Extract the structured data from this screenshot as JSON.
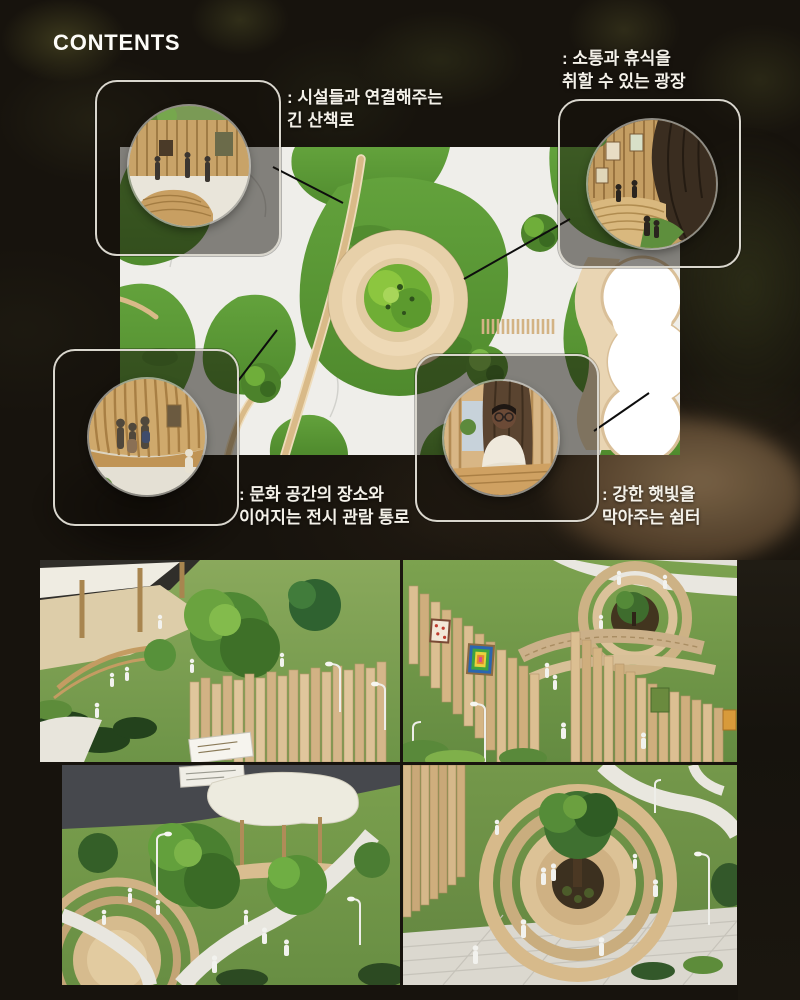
{
  "page": {
    "title": "CONTENTS"
  },
  "annotations": {
    "walkway": {
      "line1": ": 시설들과 연결해주는",
      "line2": "긴 산책로"
    },
    "plaza": {
      "line1": ": 소통과 휴식을",
      "line2": "취할 수 있는 광장"
    },
    "gallery_path": {
      "line1": ": 문화 공간의 장소와",
      "line2": "이어지는 전시 관람 통로"
    },
    "shelter": {
      "line1": ": 강한 햇빛을",
      "line2": "막아주는 쉼터"
    }
  },
  "callouts": [
    {
      "id": "walkway-photo",
      "alt": "긴 산책로 사진"
    },
    {
      "id": "plaza-photo",
      "alt": "광장 사진"
    },
    {
      "id": "gallery-photo",
      "alt": "전시 관람 통로 사진"
    },
    {
      "id": "shelter-photo",
      "alt": "쉼터 사진"
    }
  ],
  "model_photos": [
    {
      "id": "model-photo-canopy-trees"
    },
    {
      "id": "model-photo-exhibition-walls"
    },
    {
      "id": "model-photo-pavilion"
    },
    {
      "id": "model-photo-circular-platform"
    }
  ],
  "colors": {
    "background": "#17130d",
    "text": "#f4f1e9",
    "callout_border": "#d9d6cd",
    "grass": "#5c9a36",
    "path_white": "#efeeea",
    "path_tan": "#d9ba88",
    "rings_cream": "#e7d0a9",
    "wood": "#d6b88a"
  }
}
